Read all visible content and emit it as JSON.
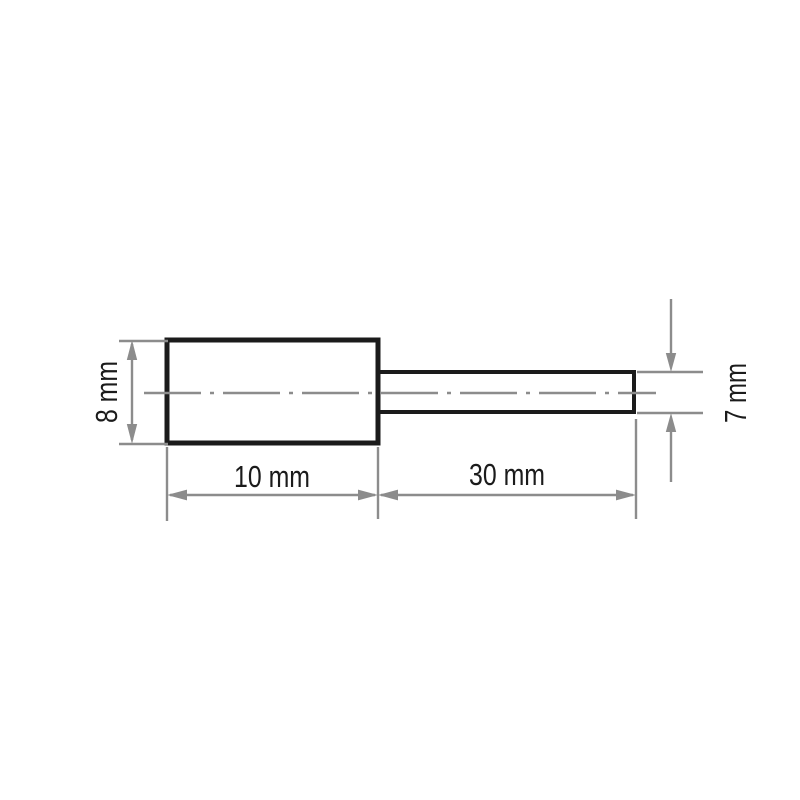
{
  "diagram": {
    "dimension_labels": {
      "head_diameter": "8 mm",
      "head_length": "10 mm",
      "shank_length": "30 mm",
      "shank_diameter": "7 mm"
    },
    "colors": {
      "outline": "#1b1b1b",
      "dimension_lines": "#8c8c8c",
      "background": "#ffffff"
    }
  }
}
